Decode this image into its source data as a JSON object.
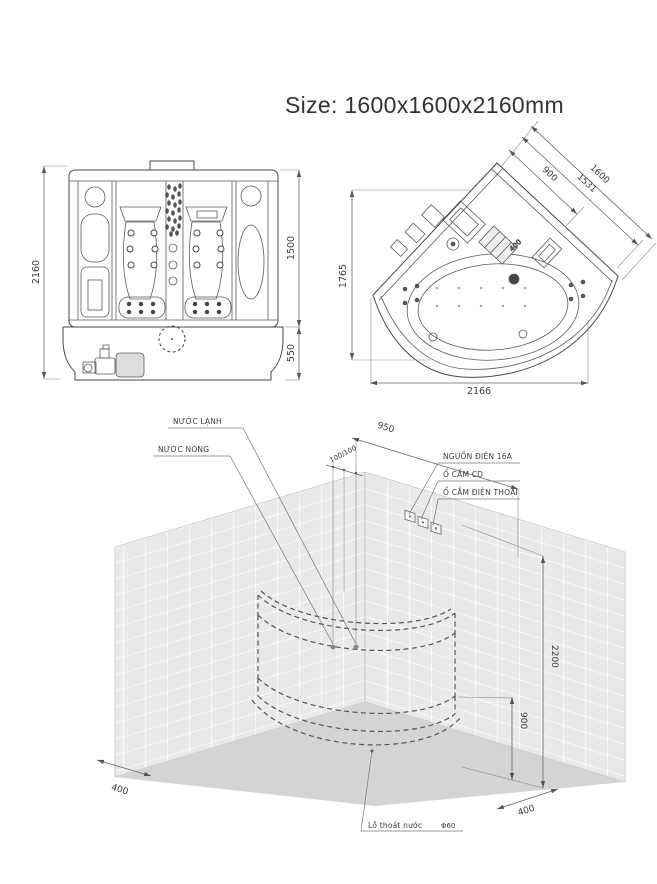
{
  "title": "Size: 1600x1600x2160mm",
  "front_view": {
    "dim_total_height": "2160",
    "dim_cabin_height": "1500",
    "dim_base_height": "550"
  },
  "plan_view": {
    "dim_door_width": "900",
    "dim_inner_width": "1531",
    "dim_side_width": "1600",
    "dim_equipment": "400",
    "dim_depth": "1765",
    "dim_front_width": "2166"
  },
  "installation": {
    "dim_wall_offset": "950",
    "dim_pipe_spacing": "100/100",
    "dim_wall_height": "2200",
    "dim_rim_height": "900",
    "dim_left_clearance": "400",
    "dim_right_clearance": "400",
    "label_cold_water": "NƯỚC LẠNH",
    "label_hot_water": "NƯỚC NÓNG",
    "label_power": "NGUỒN ĐIỆN 16A",
    "label_cd_socket": "Ổ CẮM CD",
    "label_phone_socket": "Ổ CẮM ĐIỆN THOẠI",
    "label_drain": "Lỗ thoát nước",
    "label_drain_diameter": "Φ60"
  }
}
